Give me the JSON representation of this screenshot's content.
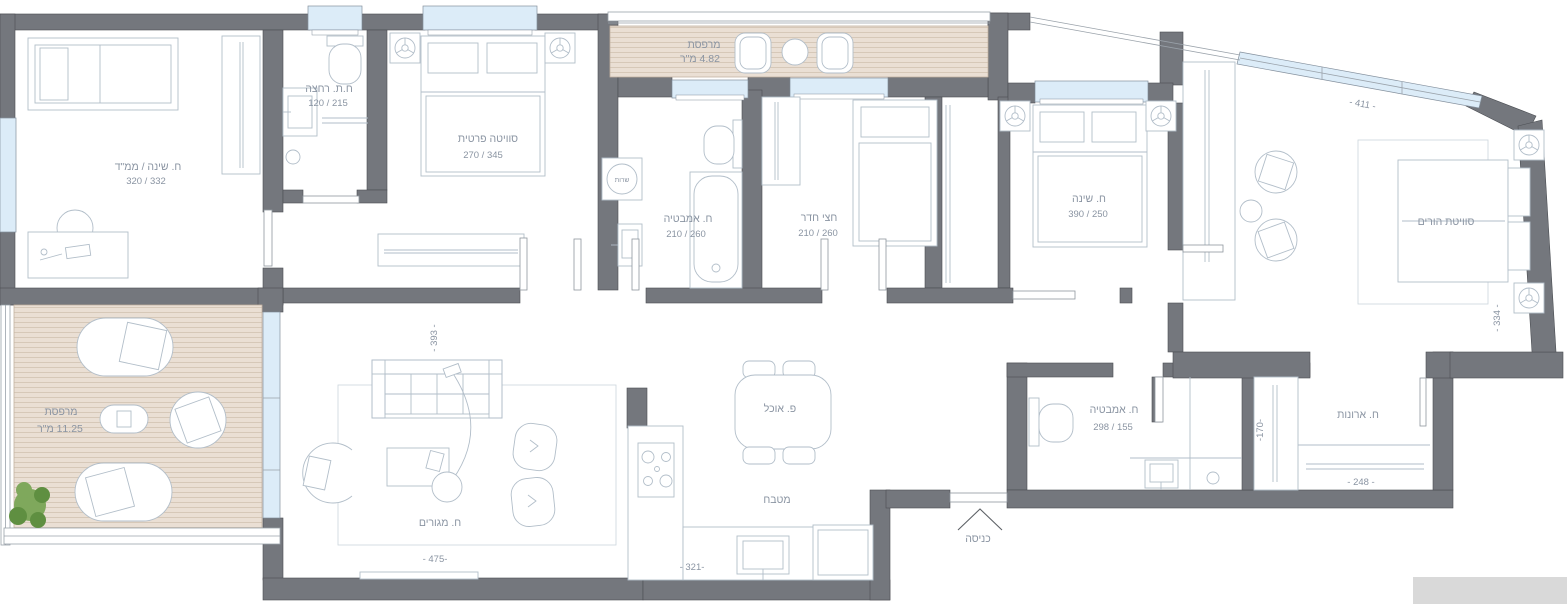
{
  "plan": {
    "type": "apartment-floor-plan",
    "colors": {
      "wall": "#74777d",
      "wall_outline": "#4b4e53",
      "window": "#dcecf8",
      "deck": "#eadfd4",
      "deck_stripe": "#d6c8b8",
      "furniture_line": "#b2bec9",
      "label_text": "#8a94a2",
      "plant": "#7fa85c"
    },
    "rooms": {
      "mamad": {
        "label": "ח. שינה / ממ\"ד",
        "dims": "320 / 332"
      },
      "guest_bath": {
        "label": "ח.ת. רחצה",
        "dims": "120 / 215"
      },
      "private_suite": {
        "label": "סוויטה פרטית",
        "dims": "270 / 345"
      },
      "balcony_top": {
        "label": "מרפסת",
        "area": "4.82 מ\"ר"
      },
      "bathroom_top": {
        "label": "ח. אמבטיה",
        "dims": "210 / 260"
      },
      "half_room": {
        "label": "חצי חדר",
        "dims": "210 / 260"
      },
      "bedroom": {
        "label": "ח. שינה",
        "dims": "390 / 250"
      },
      "parents_suite": {
        "label": "סוויטת הורים"
      },
      "balcony_main": {
        "label": "מרפסת",
        "area": "11.25 מ\"ר"
      },
      "living_room": {
        "label": "ח. מגורים"
      },
      "dining": {
        "label": "פ. אוכל"
      },
      "kitchen": {
        "label": "מטבח"
      },
      "entrance": {
        "label": "כניסה"
      },
      "bathroom_bottom": {
        "label": "ח. אמבטיה",
        "dims": "298 / 155"
      },
      "closet_room": {
        "label": "ח. ארונות"
      },
      "service_shaft": {
        "label": "שרות"
      }
    },
    "dimension_labels": {
      "living_depth": "- 393 -",
      "living_width": "- 475-",
      "kitchen_width": "- 321-",
      "parents_window": "- 411 -",
      "parents_depth": "- 334 -",
      "closet_depth": "-170-",
      "closet_width": "- 248 -"
    }
  }
}
